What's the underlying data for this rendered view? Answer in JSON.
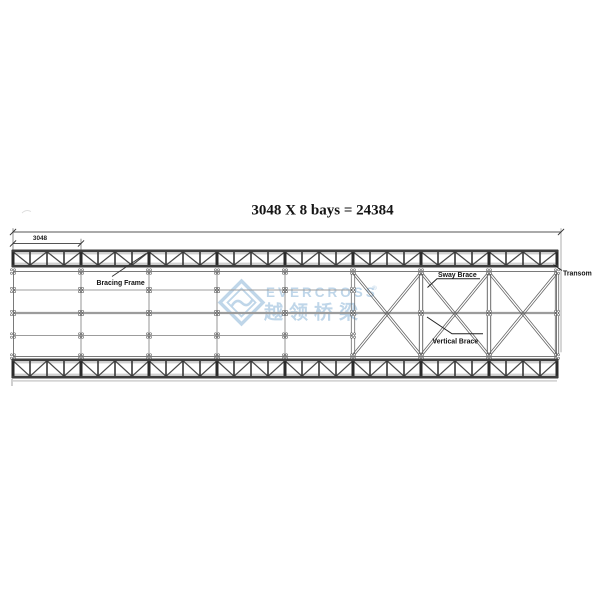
{
  "title": "3048 X 8 bays = 24384",
  "dimensions": {
    "bay_value": "3048"
  },
  "labels": {
    "bracing_frame": "Bracing Frame",
    "sway_brace": "Sway Brace",
    "vertical_brace": "Vertical Brace",
    "transom": "Transom"
  },
  "watermark": {
    "brand": "EVERCROSS",
    "registered": "®",
    "chinese": "越领桥梁",
    "color": "#aecbe3"
  },
  "structure": {
    "bays": 8,
    "bay_length_mm": 3048,
    "total_length_mm": 24384,
    "plan_grid_bays": 5,
    "x_braced_bays": 3,
    "truss_cells_per_bay": 4,
    "stringer_rows": 3
  },
  "colors": {
    "line_dark": "#3a3a3a",
    "line_mid": "#7a7a7a",
    "line_light": "#9c9c9c",
    "chord": "#3e3e3e",
    "post": "#2b2b2b",
    "diagonal": "#474747",
    "brace": "#606060",
    "grid": "#8a8a8a",
    "thin_gray": "#b3b3b3",
    "text": "#1a1a1a",
    "background": "#ffffff"
  }
}
